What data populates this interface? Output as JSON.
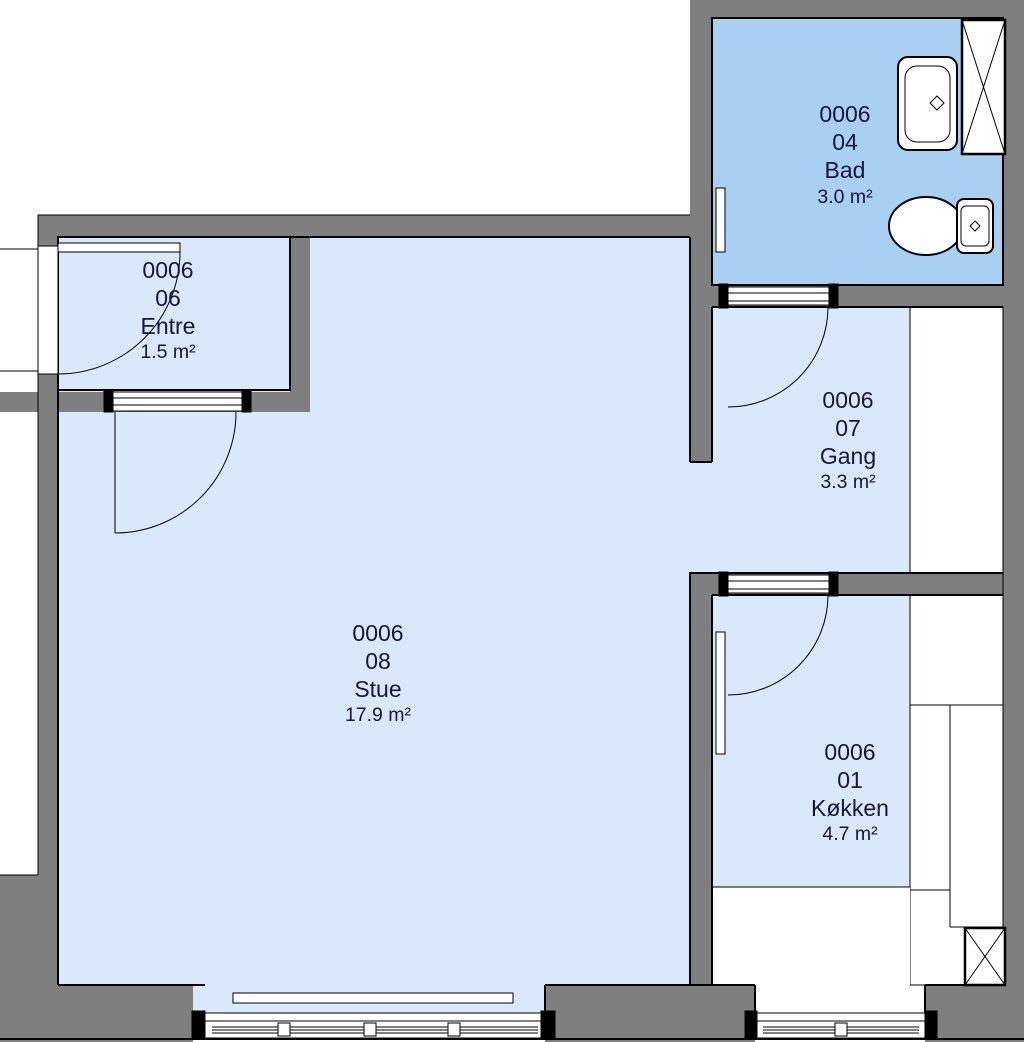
{
  "plan": {
    "title": "Apartment floor plan 0006",
    "unit": "0006",
    "rooms": [
      {
        "id": "bad",
        "unit": "0006",
        "number": "04",
        "name": "Bad",
        "area": "3.0 m²"
      },
      {
        "id": "entre",
        "unit": "0006",
        "number": "06",
        "name": "Entre",
        "area": "1.5 m²"
      },
      {
        "id": "gang",
        "unit": "0006",
        "number": "07",
        "name": "Gang",
        "area": "3.3 m²"
      },
      {
        "id": "stue",
        "unit": "0006",
        "number": "08",
        "name": "Stue",
        "area": "17.9 m²"
      },
      {
        "id": "koekken",
        "unit": "0006",
        "number": "01",
        "name": "Køkken",
        "area": "4.7 m²"
      }
    ],
    "colors": {
      "wall": "#7f7f7f",
      "room_light": "#d9e9fb",
      "room_bathroom": "#a9cff2",
      "label_text": "#15153d",
      "line": "#000000",
      "fixture_fill": "#ffffff"
    }
  }
}
